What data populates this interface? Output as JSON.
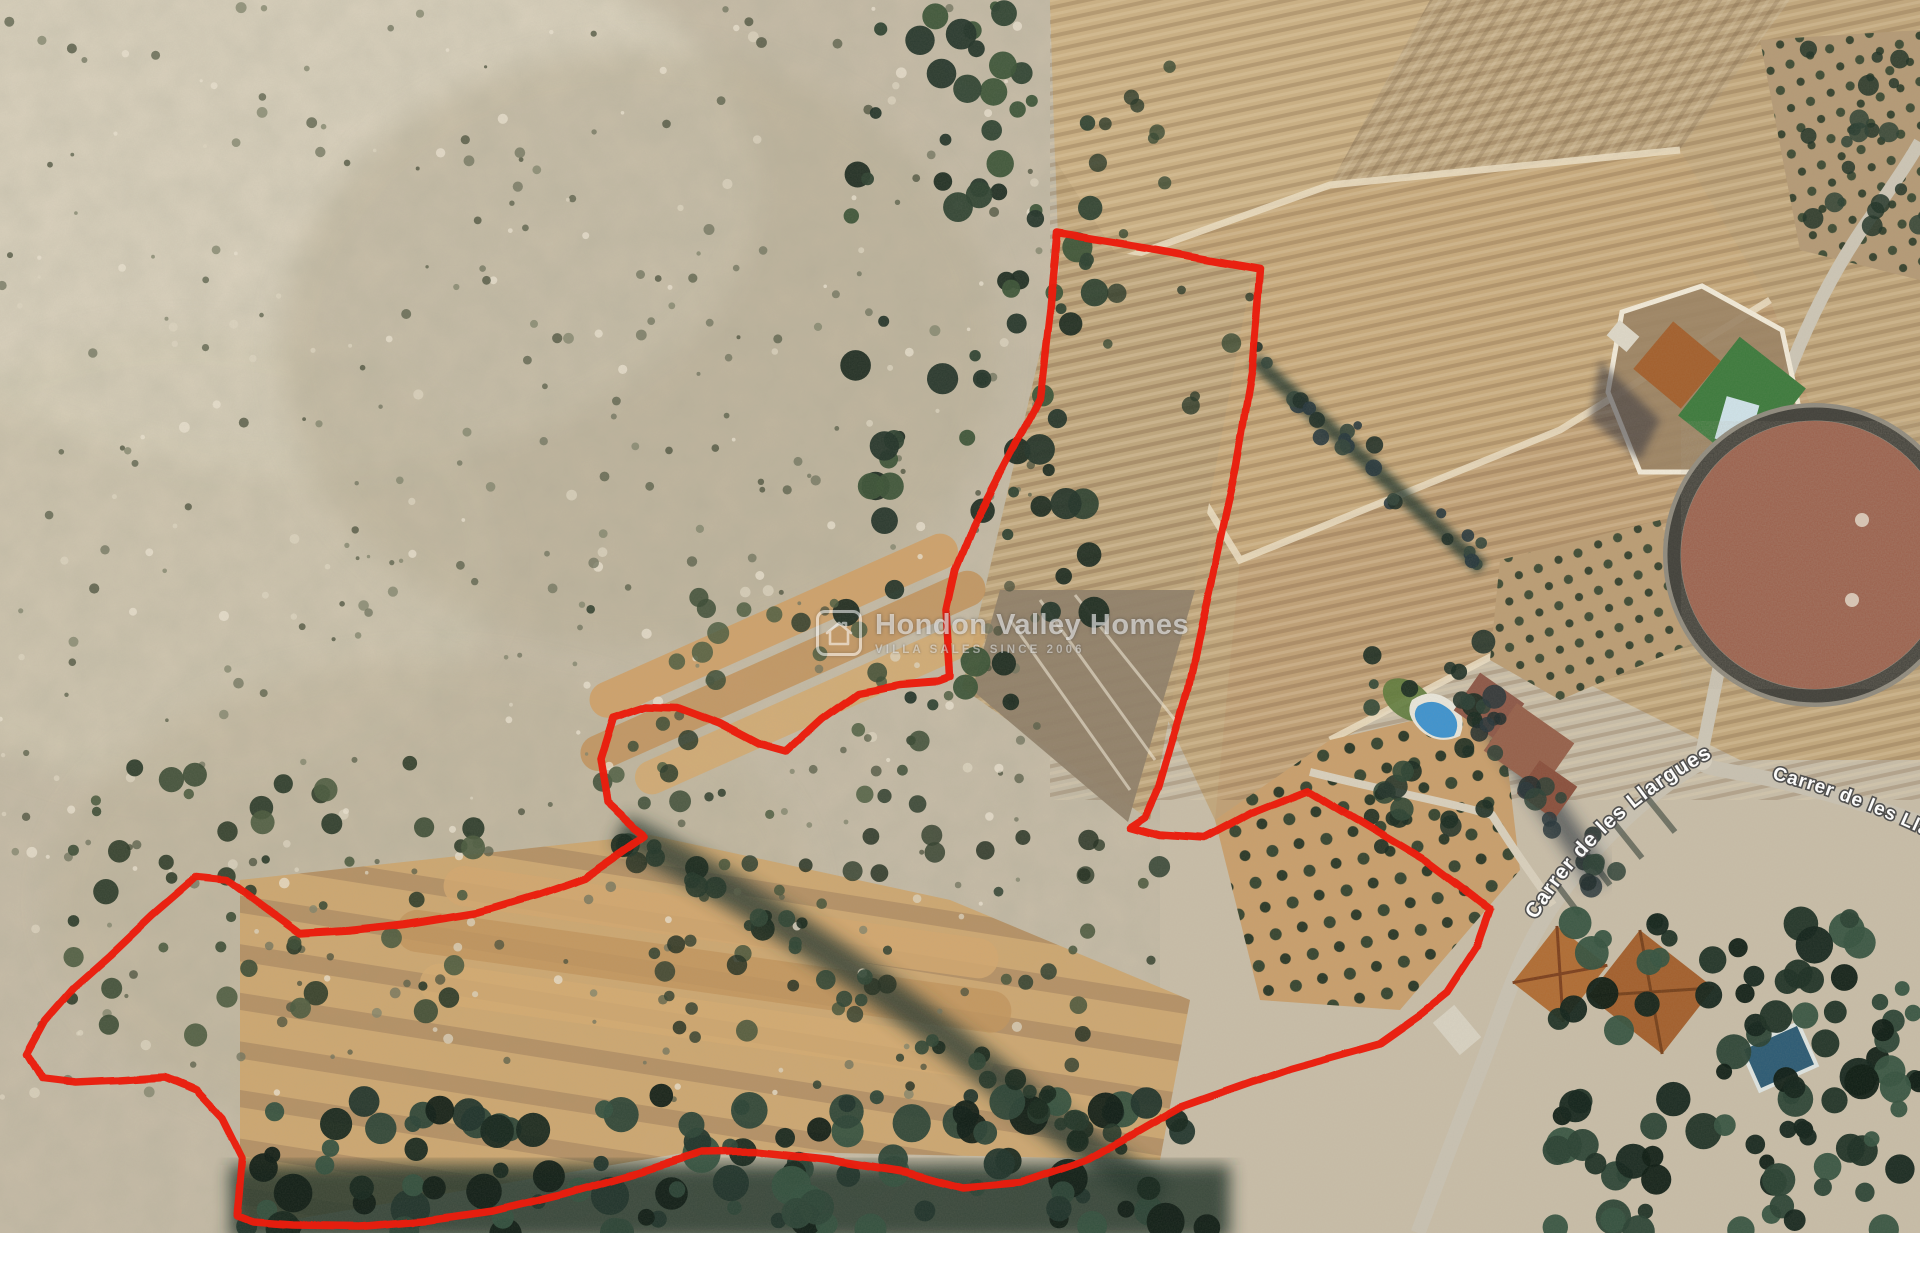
{
  "page": {
    "background": "#ffffff"
  },
  "map": {
    "kind": "satellite-aerial-photo",
    "description": "Aerial view of rural land in Hondon valley with plot boundary drawn in red",
    "width_px": 1920,
    "height_px": 1233
  },
  "watermark": {
    "brand": "Hondon Valley Homes",
    "tagline": "VILLA SALES SINCE 2006",
    "logo": "house-icon"
  },
  "road_labels": [
    {
      "text": "Carrer de les Llargues",
      "position": "curved along road, lower right"
    },
    {
      "text": "Carrer de les Llargues",
      "position": "clipped at right edge"
    }
  ],
  "boundary": {
    "color": "#ea1c0c",
    "stroke_width": 7.5,
    "points": [
      [
        1057,
        233
      ],
      [
        1148,
        248
      ],
      [
        1260,
        268
      ],
      [
        1252,
        370
      ],
      [
        1236,
        465
      ],
      [
        1214,
        568
      ],
      [
        1188,
        688
      ],
      [
        1159,
        788
      ],
      [
        1146,
        817
      ],
      [
        1131,
        827
      ],
      [
        1160,
        835
      ],
      [
        1203,
        838
      ],
      [
        1252,
        812
      ],
      [
        1307,
        790
      ],
      [
        1357,
        820
      ],
      [
        1427,
        862
      ],
      [
        1468,
        893
      ],
      [
        1490,
        910
      ],
      [
        1477,
        947
      ],
      [
        1447,
        993
      ],
      [
        1421,
        1014
      ],
      [
        1380,
        1043
      ],
      [
        1290,
        1068
      ],
      [
        1180,
        1107
      ],
      [
        1087,
        1160
      ],
      [
        1020,
        1183
      ],
      [
        963,
        1188
      ],
      [
        905,
        1172
      ],
      [
        830,
        1160
      ],
      [
        755,
        1152
      ],
      [
        700,
        1153
      ],
      [
        640,
        1172
      ],
      [
        563,
        1194
      ],
      [
        494,
        1211
      ],
      [
        430,
        1220
      ],
      [
        360,
        1226
      ],
      [
        294,
        1225
      ],
      [
        253,
        1222
      ],
      [
        237,
        1216
      ],
      [
        239,
        1196
      ],
      [
        242,
        1158
      ],
      [
        222,
        1118
      ],
      [
        196,
        1090
      ],
      [
        165,
        1077
      ],
      [
        120,
        1080
      ],
      [
        75,
        1082
      ],
      [
        42,
        1078
      ],
      [
        27,
        1053
      ],
      [
        45,
        1020
      ],
      [
        73,
        988
      ],
      [
        110,
        955
      ],
      [
        152,
        915
      ],
      [
        196,
        877
      ],
      [
        228,
        880
      ],
      [
        262,
        905
      ],
      [
        300,
        933
      ],
      [
        348,
        930
      ],
      [
        404,
        924
      ],
      [
        478,
        912
      ],
      [
        539,
        894
      ],
      [
        585,
        878
      ],
      [
        622,
        852
      ],
      [
        645,
        836
      ],
      [
        633,
        827
      ],
      [
        607,
        803
      ],
      [
        600,
        760
      ],
      [
        613,
        718
      ],
      [
        645,
        707
      ],
      [
        677,
        708
      ],
      [
        720,
        724
      ],
      [
        760,
        745
      ],
      [
        785,
        752
      ],
      [
        822,
        718
      ],
      [
        858,
        692
      ],
      [
        900,
        684
      ],
      [
        940,
        681
      ],
      [
        951,
        677
      ],
      [
        947,
        612
      ],
      [
        956,
        570
      ],
      [
        974,
        526
      ],
      [
        1010,
        457
      ],
      [
        1040,
        398
      ],
      [
        1050,
        310
      ]
    ]
  }
}
